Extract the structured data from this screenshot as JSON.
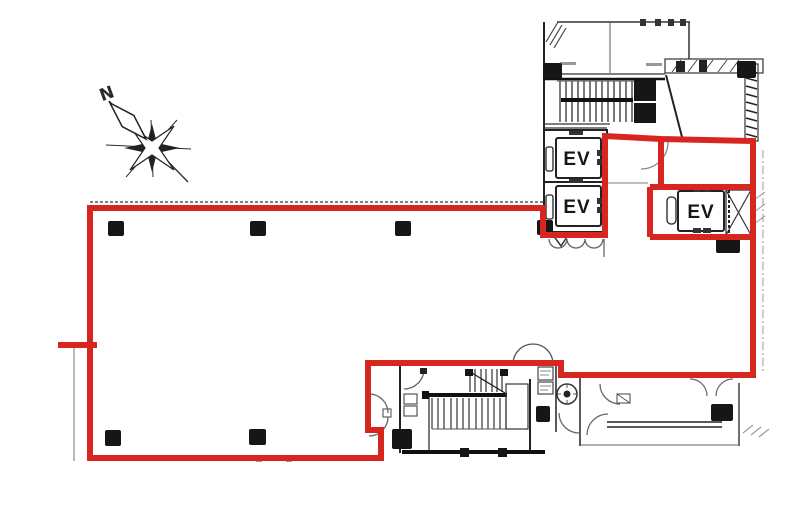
{
  "drawing": {
    "kind": "building floor plan",
    "compass": {
      "north_label": "N"
    },
    "elevators": [
      {
        "label": "EV"
      },
      {
        "label": "EV"
      },
      {
        "label": "EV"
      }
    ],
    "colors": {
      "lease_boundary": "#d7261f",
      "wall": "#161616",
      "detail": "#555555",
      "light": "#999999"
    }
  }
}
